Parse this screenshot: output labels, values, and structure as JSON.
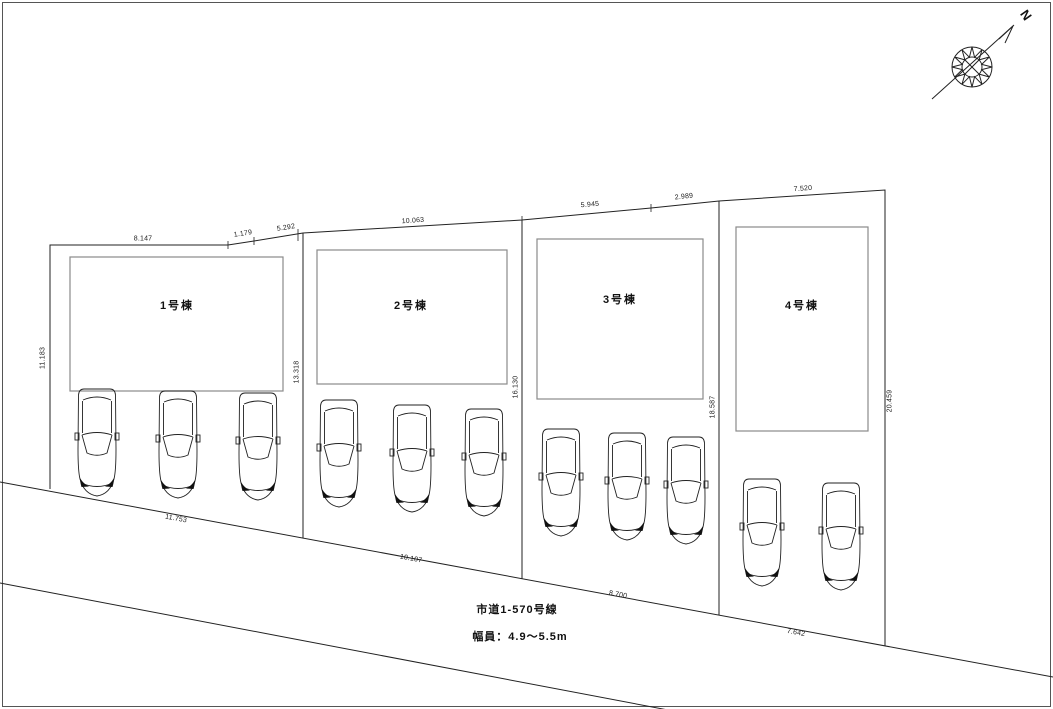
{
  "compass": {
    "north_label": "N"
  },
  "buildings": [
    {
      "label": "1号棟"
    },
    {
      "label": "2号棟"
    },
    {
      "label": "3号棟"
    },
    {
      "label": "4号棟"
    }
  ],
  "dimensions": {
    "top": [
      "8.147",
      "1.179",
      "5.292",
      "10.063",
      "5.945",
      "2.989",
      "7.520"
    ],
    "side": [
      "11.183",
      "13.318",
      "16.130",
      "18.587",
      "20.459"
    ],
    "frontage": [
      "11.753",
      "10.107",
      "8.700",
      "7.642"
    ]
  },
  "road": {
    "name": "市道1-570号線",
    "width": "幅員：4.9〜5.5m"
  },
  "parking": {
    "car_counts_per_lot": [
      3,
      3,
      3,
      2
    ]
  }
}
